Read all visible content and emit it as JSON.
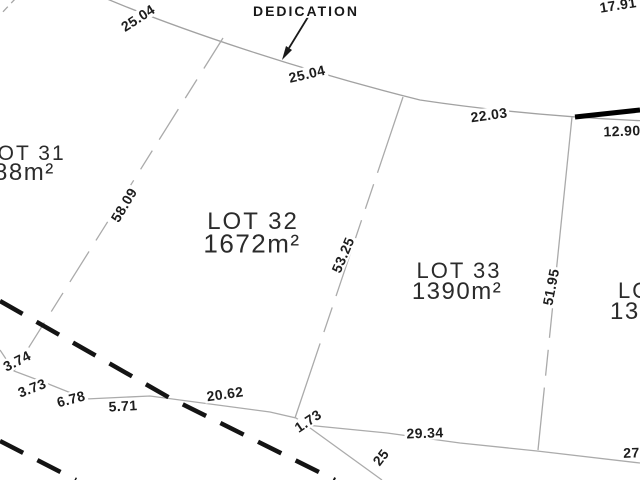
{
  "colors": {
    "background": "#ffffff",
    "thin_line_gray": "#a6a6a6",
    "bold_line_black": "#141414",
    "text_dark": "#1d1d1d"
  },
  "annotations": {
    "dedication": "DEDICATION"
  },
  "lots": {
    "lot31": {
      "name": "LOT 31",
      "area": "88m²"
    },
    "lot32": {
      "name": "LOT 32",
      "area": "1672m²"
    },
    "lot33": {
      "name": "LOT 33",
      "area": "1390m²"
    },
    "lot34": {
      "name": "LOT 34",
      "area": "130"
    }
  },
  "dimensions": {
    "frontage_left": "25.04",
    "frontage_dedication": "25.04",
    "frontage_lot33": "22.03",
    "road_right": "12.90",
    "top_right": "17.91",
    "side_lot31_lot32": "58.09",
    "side_lot32_lot33": "53.25",
    "side_lot33_lot34": "51.95",
    "rear_3_74": "3.74",
    "rear_3_73": "3.73",
    "rear_6_78": "6.78",
    "rear_5_71": "5.71",
    "rear_20_62": "20.62",
    "rear_1_73": "1.73",
    "rear_29_34": "29.34",
    "rear_27": "27",
    "rear_25": "25"
  }
}
